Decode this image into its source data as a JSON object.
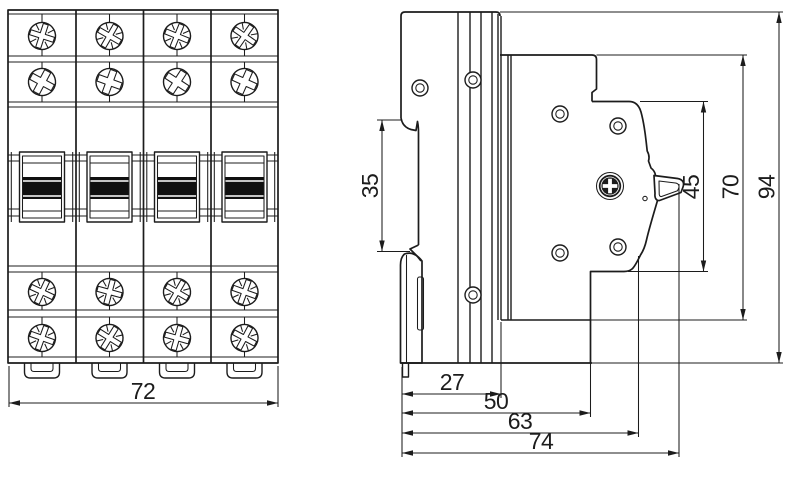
{
  "drawing": {
    "type": "technical-dimension-drawing",
    "subject": "4-pole modular circuit breaker, front view and side view",
    "colors": {
      "line": "#1c1c1c",
      "background": "#ffffff",
      "handle_fill": "#101010"
    }
  },
  "dimensions": {
    "front_width": "72",
    "din_slot_height": "35",
    "escutcheon_height": "45",
    "housing_height": "70",
    "overall_height": "94",
    "depth_rear": "27",
    "depth_body": "50",
    "depth_escutcheon": "63",
    "depth_overall": "74"
  }
}
